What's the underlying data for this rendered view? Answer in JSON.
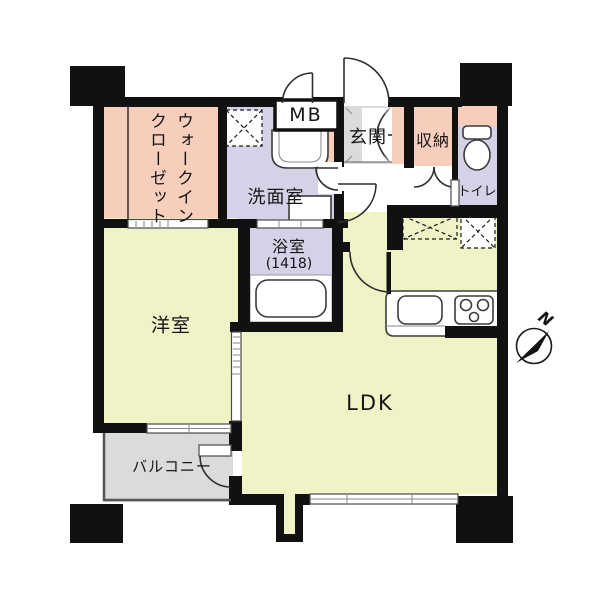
{
  "rooms": {
    "walk_in_closet": {
      "label": "ウォークインクローゼット",
      "color": "#F6CEBB"
    },
    "washroom": {
      "label": "洗面室",
      "color": "#D5D2E8"
    },
    "meter_box": {
      "label": "MB",
      "color": "#FFFFFF"
    },
    "entrance": {
      "label": "玄関",
      "color": "#DBDBDB"
    },
    "storage": {
      "label": "収納",
      "color": "#F6CEBB"
    },
    "toilet": {
      "label": "トイレ",
      "color": "#D5D2E8"
    },
    "bathroom": {
      "label": "浴室",
      "size_label": "(1418)",
      "color": "#D5D2E8"
    },
    "western_room": {
      "label": "洋室",
      "color": "#F0F3C6"
    },
    "ldk": {
      "label": "LDK",
      "color": "#F0F3C6"
    },
    "balcony": {
      "label": "バルコニー",
      "color": "#DBDBDB"
    }
  },
  "compass": {
    "label": "N"
  },
  "colors": {
    "wall": "#111111",
    "pink": "#F6CEBB",
    "lavender": "#D5D2E8",
    "yellow": "#F0F3C6",
    "gray": "#DBDBDB",
    "white": "#FFFFFF"
  }
}
